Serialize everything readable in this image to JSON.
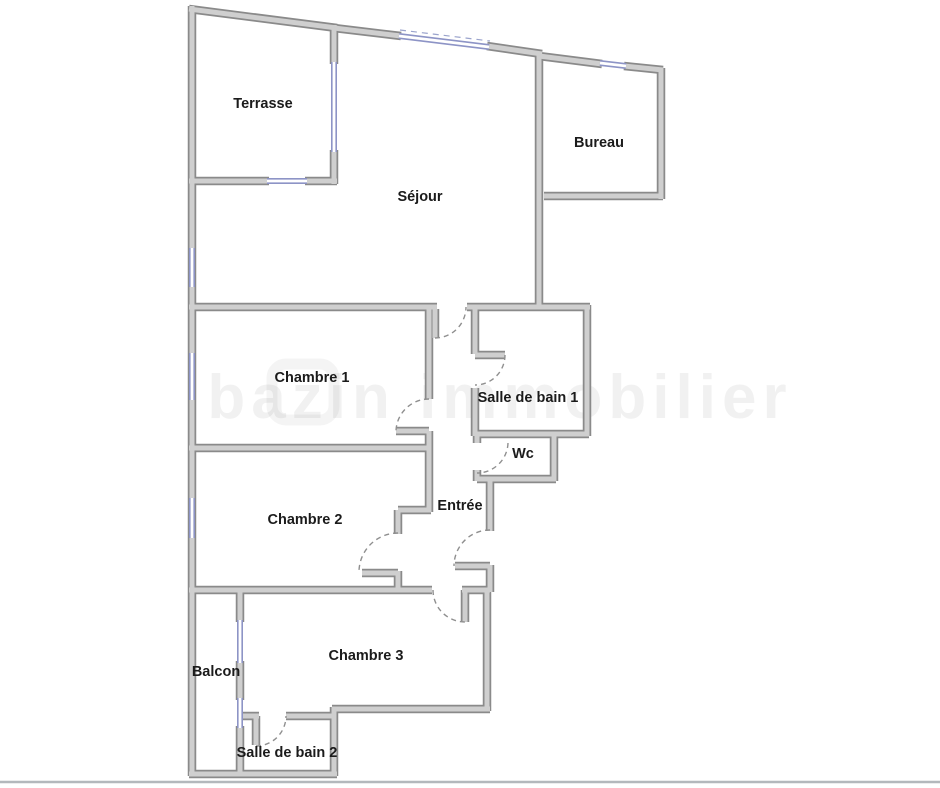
{
  "plan": {
    "rooms": {
      "terrasse": {
        "label": "Terrasse"
      },
      "sejour": {
        "label": "Séjour"
      },
      "bureau": {
        "label": "Bureau"
      },
      "chambre1": {
        "label": "Chambre 1"
      },
      "sdb1": {
        "label": "Salle de bain 1"
      },
      "wc": {
        "label": "Wc"
      },
      "chambre2": {
        "label": "Chambre 2"
      },
      "entree": {
        "label": "Entrée"
      },
      "chambre3": {
        "label": "Chambre 3"
      },
      "balcon": {
        "label": "Balcon"
      },
      "sdb2": {
        "label": "Salle de bain 2"
      }
    },
    "watermark": {
      "text": "bazin immobilier"
    },
    "colors": {
      "wall_outline": "#8a8a8a",
      "wall_fill": "#cfcfcf",
      "window": "#8d94c6",
      "door_arc": "#8f8f8f",
      "label_text": "#1b1b1b",
      "page_border": "#b4b8bc"
    }
  }
}
